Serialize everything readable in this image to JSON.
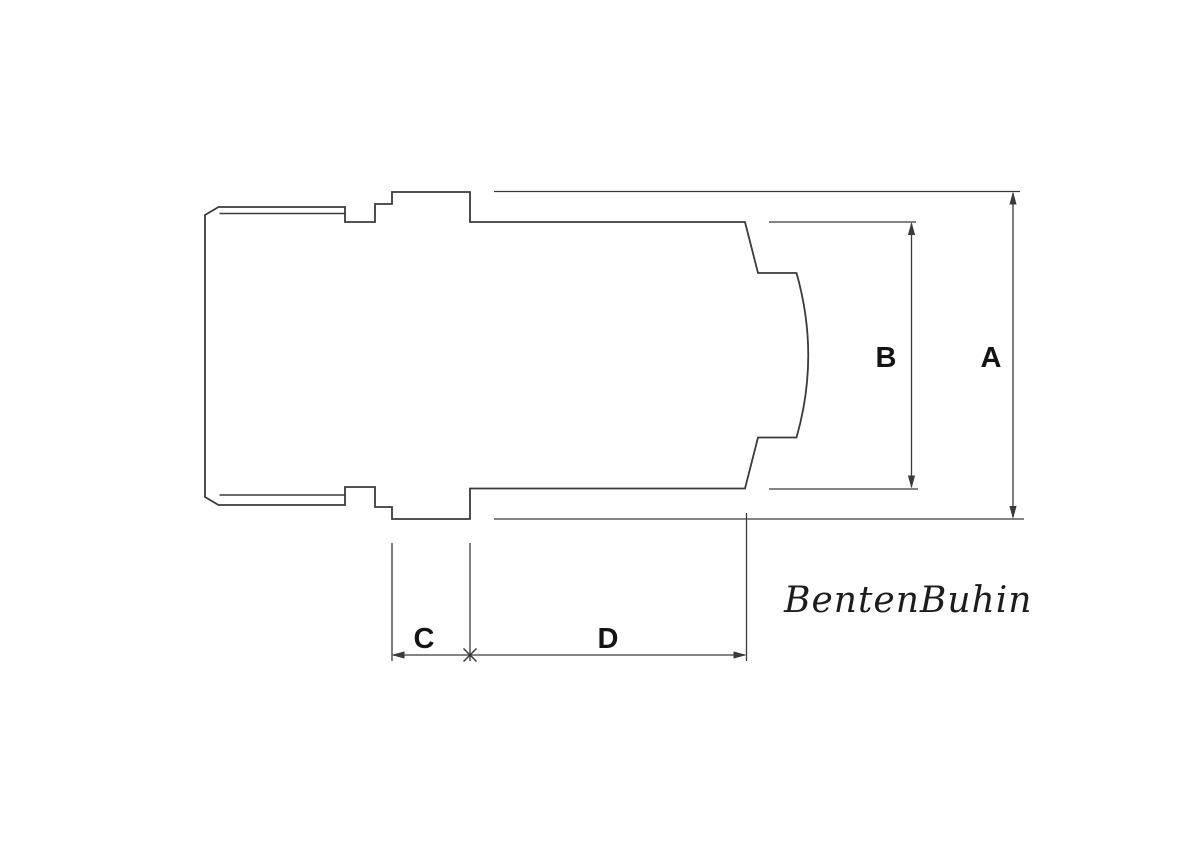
{
  "meta": {
    "background": "#ffffff",
    "line_color": "#3a3a3a",
    "dim_line_color": "#3a3a3a",
    "label_color": "#141414",
    "watermark_color": "#1c1c1c"
  },
  "drawing": {
    "type": "technical-dimension-drawing",
    "subject": "turned pipe fitting side profile",
    "dimensions": {
      "a": {
        "label": "A"
      },
      "b": {
        "label": "B"
      },
      "c": {
        "label": "C"
      },
      "d": {
        "label": "D"
      }
    },
    "watermark": {
      "text": "BentenBuhin"
    }
  }
}
